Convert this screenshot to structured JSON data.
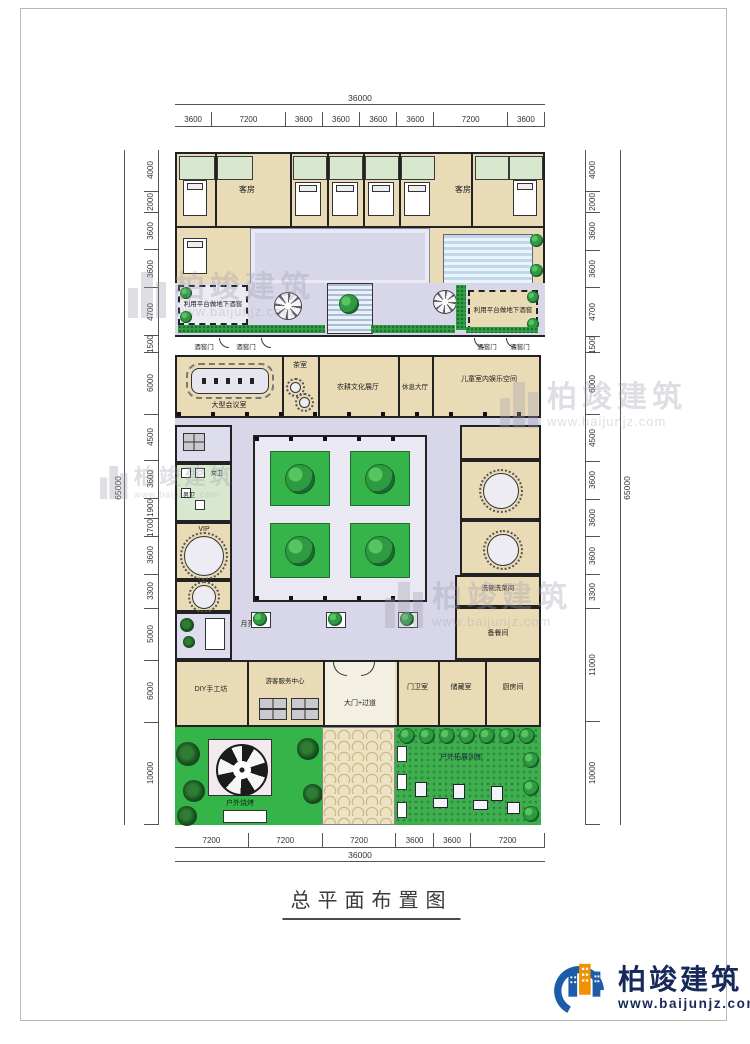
{
  "title": {
    "text": "总平面布置图"
  },
  "dimensions": {
    "top": {
      "total": "36000",
      "segments": [
        "3600",
        "7200",
        "3600",
        "3600",
        "3600",
        "3600",
        "7200",
        "3600"
      ]
    },
    "bottom": {
      "total": "36000",
      "segments": [
        "7200",
        "7200",
        "7200",
        "3600",
        "3600",
        "7200"
      ]
    },
    "left": {
      "total": "65000",
      "segments": [
        "4000",
        "2000",
        "3600",
        "3600",
        "4700",
        "1500",
        "6000",
        "4500",
        "3600",
        "1900",
        "1700",
        "3600",
        "3300",
        "5000",
        "6000",
        "10000"
      ]
    },
    "right": {
      "total": "65000",
      "segments": [
        "4000",
        "2000",
        "3600",
        "3600",
        "4700",
        "1500",
        "6000",
        "4500",
        "3600",
        "3600",
        "3600",
        "3300",
        "11000",
        "10000"
      ]
    }
  },
  "rooms": {
    "guest_room": "客房",
    "cellar": "利用平台做地下酒窖",
    "cellar_door": "酒窖门",
    "conference": "大型会议室",
    "tea_room": "茶室",
    "exhibition_hall": "农耕文化展厅",
    "lounge_hall": "休息大厅",
    "kids_space": "儿童室内娱乐空间",
    "womens_wc": "女卫",
    "mens_wc": "男卫",
    "vip": "VIP",
    "moon_gate": "月亮门",
    "wash_room": "洗碗洗菜间",
    "prep_room": "备餐间",
    "diy_workshop": "DIY手工坊",
    "visitor_center": "游客服务中心",
    "main_gate": "大门+过道",
    "guard_room": "门卫室",
    "storage_room": "储藏室",
    "kitchen": "厨房间",
    "bbq_area": "户外烧烤",
    "training_area": "户外拓展训练"
  },
  "watermark": {
    "brand": "柏竣建筑",
    "url": "www.baijunjz.com"
  },
  "logo": {
    "brand": "柏竣建筑",
    "url": "www.baijunjz.com"
  },
  "colors": {
    "wall": "#222222",
    "room_beige": "#EADBB7",
    "courtyard_lavender": "#D8D7EA",
    "lawn_green": "#35B44A",
    "hedge_green": "#2F9E43",
    "logo_navy": "#17295A",
    "logo_orange": "#F29200",
    "logo_blue": "#1D5CA8"
  }
}
